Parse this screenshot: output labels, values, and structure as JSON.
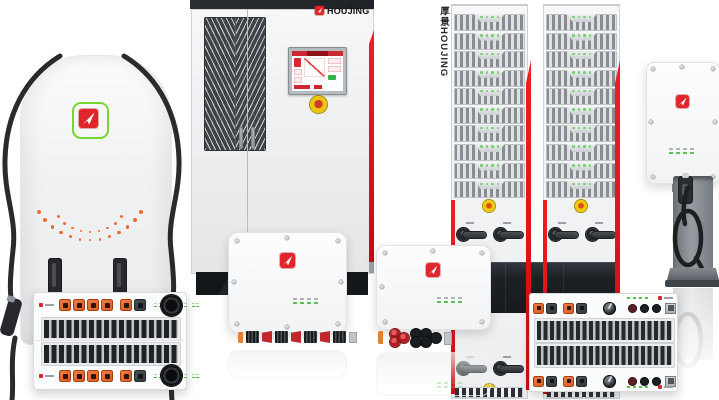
{
  "brand": {
    "name": "HOUJING",
    "name_cn": "厚景",
    "rack_vertical_label": "厚景HOUJING",
    "logo_icon": "white-arrow-in-red-rounded-square",
    "pillar_logo_frame": "green-rounded-square-outline"
  },
  "colors": {
    "logo_red": "#e2252b",
    "accent_stripe_red": "#e30613",
    "hmi_red": "#cf2730",
    "connector_orange": "#e2622a",
    "led_green": "#5ec455",
    "estop_yellow": "#edc40c",
    "estop_core_red": "#cf3a2c",
    "dark_base": "#1f2327",
    "cable_black": "#202224",
    "panel_light": "#f2f3f4"
  },
  "counts": {
    "rack_cabinets": 2,
    "rack_modules_per_cabinet": 10,
    "pillar_led_arcs": 2,
    "module_left_orange_connectors": 4,
    "module_left_led_groups": 4,
    "led_columns": 4
  },
  "pillar": {
    "arc_outer": {
      "count": 13,
      "r": 60,
      "cx": 64,
      "cy": -4,
      "spread": 116,
      "min": 2.5,
      "max": 4.5
    },
    "arc_inner": {
      "count": 9,
      "r": 40,
      "cx": 64,
      "cy": 8,
      "spread": 104,
      "min": 2,
      "max": 3.5
    }
  },
  "products": {
    "pillar_charger": "dual-cable charging pillar",
    "power_module_left": "stacked rack power module",
    "charging_cabinet": "charging cabinet with HMI and e-stop",
    "wall_converter_large": "wall-mount converter unit",
    "wall_converter_small": "wall-mount converter unit",
    "power_racks": "module rack cabinets",
    "power_module_right": "wide rack power module",
    "wall_charger": "wall-mount charger",
    "pedestal_charger": "pedestal charger with coiled cable"
  }
}
